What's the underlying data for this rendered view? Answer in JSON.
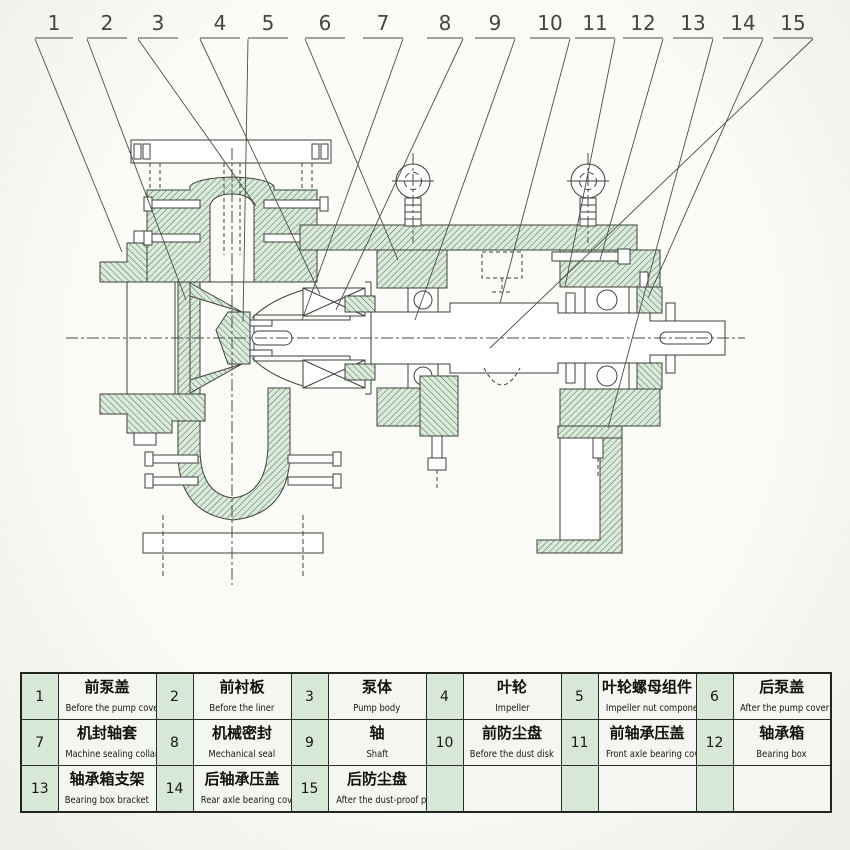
{
  "callouts": [
    "1",
    "2",
    "3",
    "4",
    "5",
    "6",
    "7",
    "8",
    "9",
    "10",
    "11",
    "12",
    "13",
    "14",
    "15"
  ],
  "colors": {
    "page_bg": "#f9f9f5",
    "drawing_line": "#3e413b",
    "section_hatch_fill": "#d9ecda",
    "table_number_cell_bg": "#d8e8d7",
    "table_label_cell_bg": "#f4f7f1",
    "table_border": "#22241f"
  },
  "parts_table": {
    "rows": [
      [
        {
          "no": "1",
          "cn": "前泵盖",
          "en": "Before the pump cover"
        },
        {
          "no": "2",
          "cn": "前衬板",
          "en": "Before the liner"
        },
        {
          "no": "3",
          "cn": "泵体",
          "en": "Pump body"
        },
        {
          "no": "4",
          "cn": "叶轮",
          "en": "Impeller"
        },
        {
          "no": "5",
          "cn": "叶轮螺母组件",
          "en": "Impeller nut component"
        },
        {
          "no": "6",
          "cn": "后泵盖",
          "en": "After the pump cover"
        }
      ],
      [
        {
          "no": "7",
          "cn": "机封轴套",
          "en": "Machine sealing collar"
        },
        {
          "no": "8",
          "cn": "机械密封",
          "en": "Mechanical seal"
        },
        {
          "no": "9",
          "cn": "轴",
          "en": "Shaft"
        },
        {
          "no": "10",
          "cn": "前防尘盘",
          "en": "Before the dust disk"
        },
        {
          "no": "11",
          "cn": "前轴承压盖",
          "en": "Front axle bearing cover"
        },
        {
          "no": "12",
          "cn": "轴承箱",
          "en": "Bearing box"
        }
      ],
      [
        {
          "no": "13",
          "cn": "轴承箱支架",
          "en": "Bearing box bracket"
        },
        {
          "no": "14",
          "cn": "后轴承压盖",
          "en": "Rear axle bearing cover"
        },
        {
          "no": "15",
          "cn": "后防尘盘",
          "en": "After the dust-proof plate"
        }
      ]
    ]
  }
}
